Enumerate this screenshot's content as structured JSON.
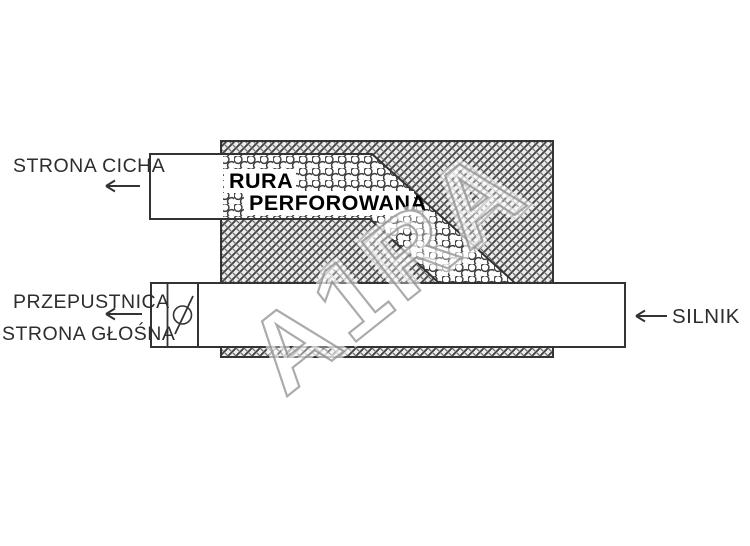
{
  "diagram": {
    "labels": {
      "quiet_side": "STRONA CICHA",
      "throttle": "PRZEPUSTNICA",
      "loud_side": "STRONA GŁOŚNA",
      "engine": "SILNIK",
      "perforated_line1": "RURA",
      "perforated_line2": "PERFOROWANA"
    },
    "watermark": "A1RA",
    "colors": {
      "background": "#ffffff",
      "line": "#333333",
      "text": "#2d2d2d",
      "hatch": "#454545",
      "hatch_bg": "#ededed",
      "watermark_outline": "#909090"
    }
  }
}
